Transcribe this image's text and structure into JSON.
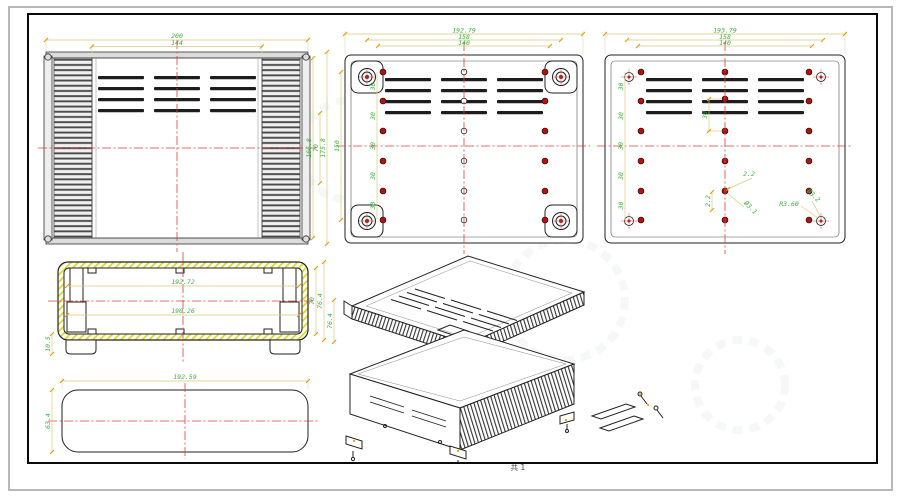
{
  "sheet": {
    "label": "共 1"
  },
  "colors": {
    "dim_text": "#3cb043",
    "dim_line": "#d8ca7e",
    "dim_tick": "#e39a00",
    "centerline": "#e04038",
    "hole_fill": "#a81612",
    "hatch": "#d8d832",
    "outline": "#222222"
  },
  "views": {
    "front": {
      "dim_outer_width": "200",
      "dim_inner_width": "144",
      "dim_height_a": "166.8",
      "dim_height_b": "70",
      "dim_height_c": "175.8"
    },
    "bottom": {
      "dim_width_a": "192.79",
      "dim_width_b": "158",
      "dim_width_c": "140",
      "dim_height_overall": "150",
      "hole_pitch": "30"
    },
    "rear": {
      "dim_width_a": "193.79",
      "dim_width_b": "158",
      "dim_width_c": "140",
      "hole_pitch": "30",
      "vent_hole_offset": "30",
      "callout_offset_x": "2.2",
      "callout_offset_y": "2.2",
      "callout_hole_dia": "Ø3.1",
      "callout_corner_radius": "R3.60",
      "callout_corner_dia": "Ø3.2"
    },
    "section": {
      "dim_inner_width_top": "192.72",
      "dim_inner_width_bottom": "190.26",
      "dim_base_height": "10.5",
      "dim_inner_height": "70",
      "dim_outer_height": "76.4"
    },
    "panel": {
      "dim_width": "192.59",
      "dim_height": "63.4"
    },
    "iso": {
      "dim_height": "76.4"
    }
  }
}
